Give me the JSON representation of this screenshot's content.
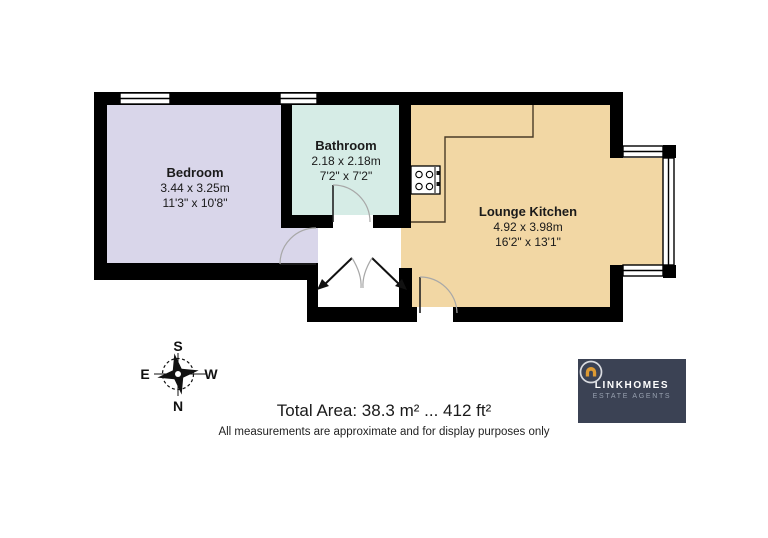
{
  "plan": {
    "rooms": [
      {
        "id": "bedroom",
        "name": "Bedroom",
        "dims_metric": "3.44 x 3.25m",
        "dims_imperial": "11'3\" x 10'8\"",
        "floor_color": "#d9d6ea"
      },
      {
        "id": "bathroom",
        "name": "Bathroom",
        "dims_metric": "2.18 x 2.18m",
        "dims_imperial": "7'2\" x 7'2\"",
        "floor_color": "#d6ece6"
      },
      {
        "id": "lounge-kitchen",
        "name": "Lounge Kitchen",
        "dims_metric": "4.92 x 3.98m",
        "dims_imperial": "16'2\" x 13'1\"",
        "floor_color": "#f2d7a4"
      }
    ],
    "wall_color": "#000000",
    "door_arc_color": "#a8a8a8"
  },
  "compass": {
    "north": "N",
    "south": "S",
    "east": "E",
    "west": "W"
  },
  "footer": {
    "total_area": "Total Area: 38.3 m² ... 412 ft²",
    "disclaimer": "All measurements are approximate and for display purposes only"
  },
  "logo": {
    "name": "LINKHOMES",
    "tagline": "ESTATE AGENTS",
    "background": "#3b4254",
    "accent": "#dd9a33"
  }
}
